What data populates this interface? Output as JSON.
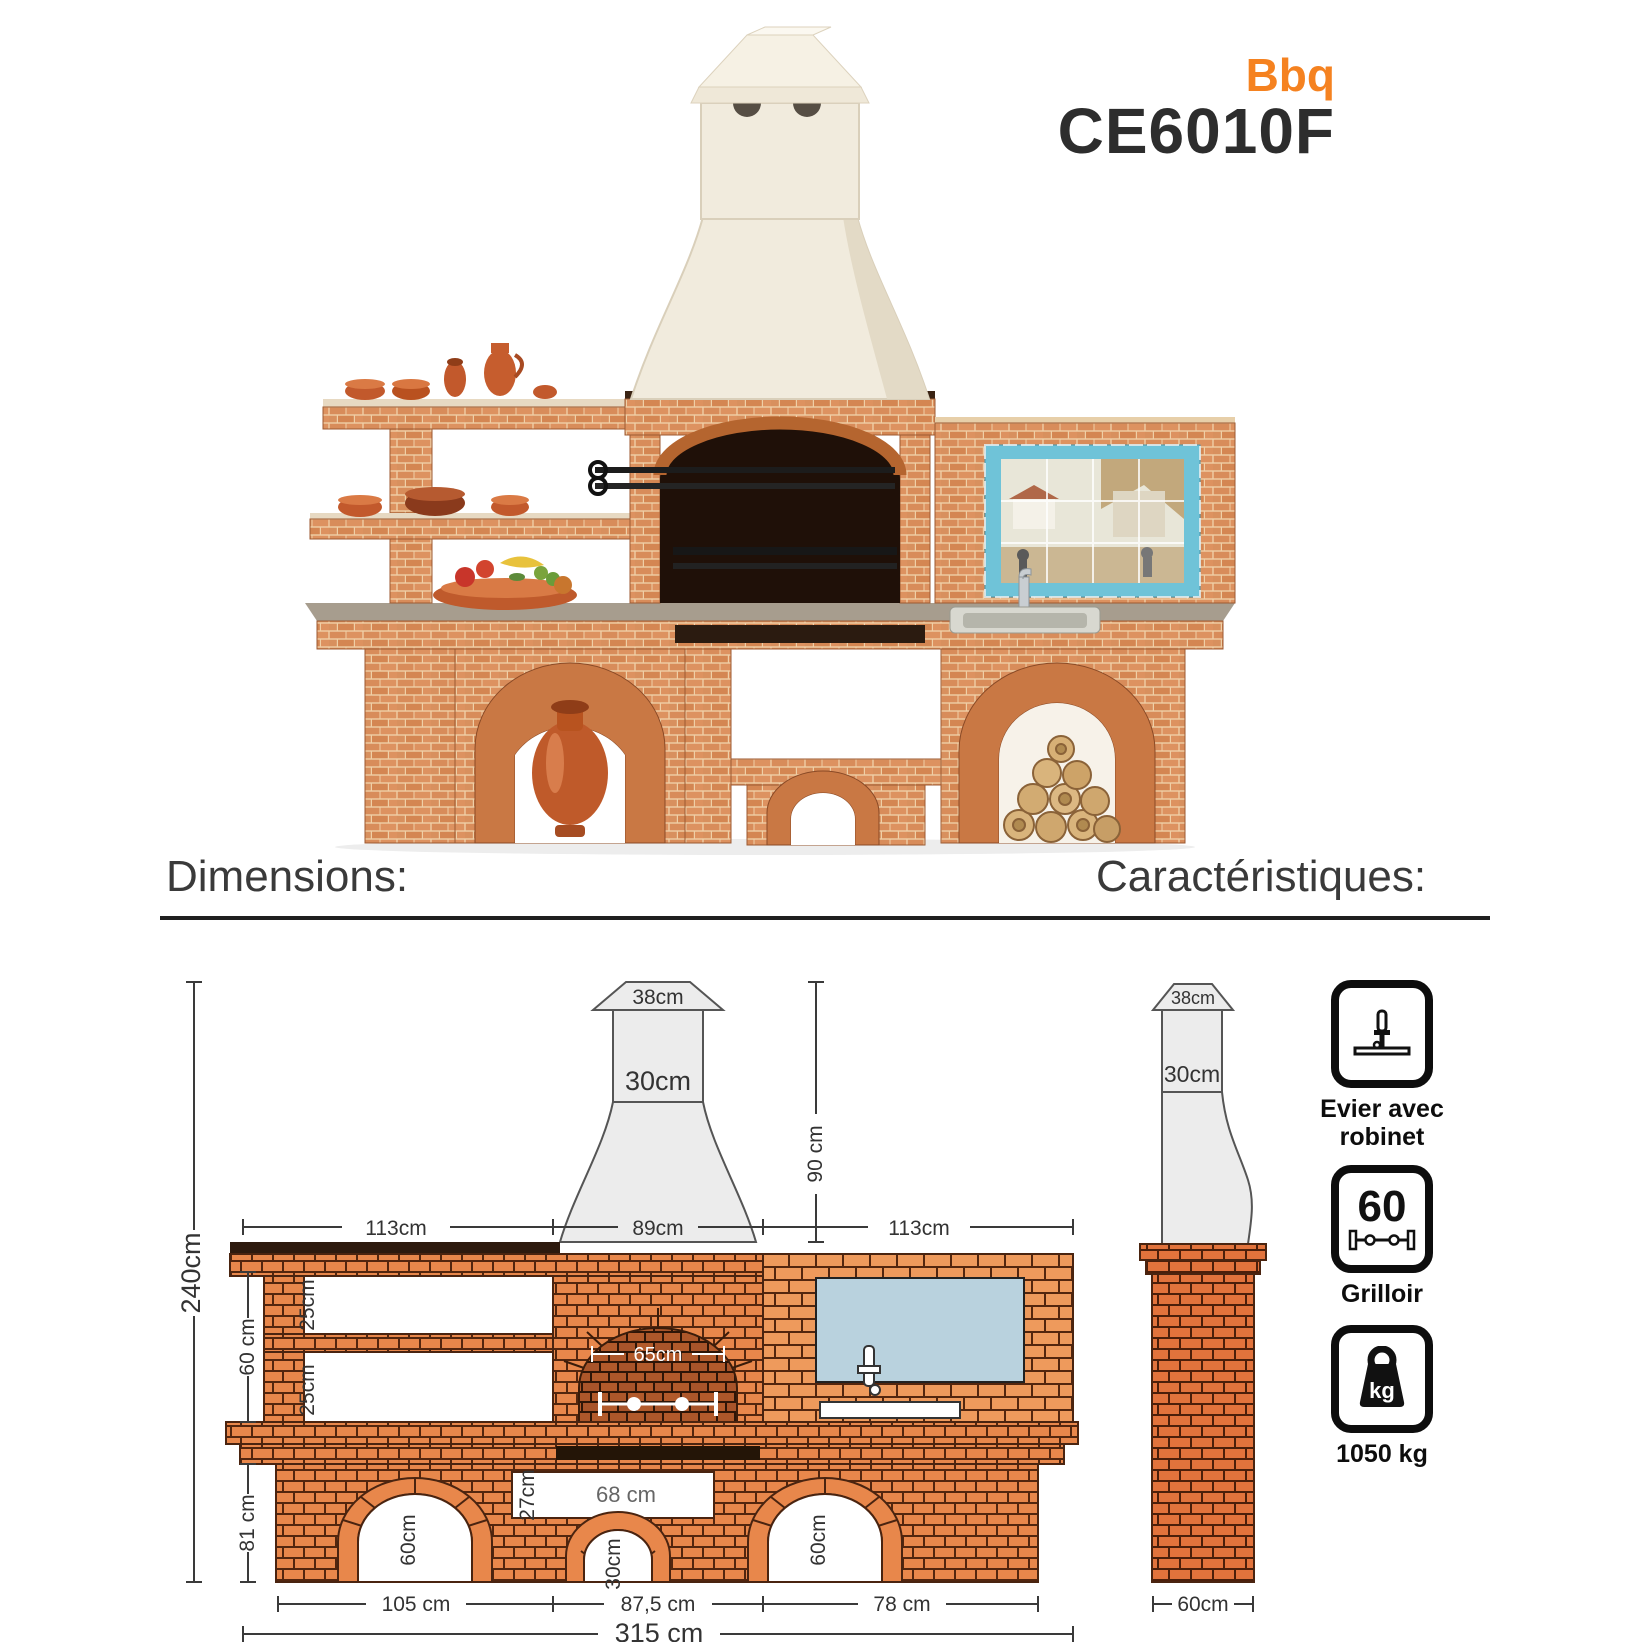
{
  "product": {
    "brand_tag": "Bbq",
    "model": "CE6010F",
    "accent_color": "#F58220"
  },
  "sections": {
    "dimensions_heading": "Dimensions:",
    "characteristics_heading": "Caractéristiques:"
  },
  "drawing": {
    "front": {
      "cap_width": "38cm",
      "chimney_width": "30cm",
      "hood_height": "90 cm",
      "left_span": "113cm",
      "firebox_span": "89cm",
      "right_span": "113cm",
      "shelf_gap_upper": "25cm",
      "shelf_gap_lower": "25cm",
      "shelf_zone": "60 cm",
      "total_height": "240cm",
      "base_height": "81 cm",
      "firebox_inner": "65cm",
      "niche_height": "27cm",
      "niche_width": "68 cm",
      "arch_left": "60cm",
      "arch_center": "30cm",
      "arch_right": "60cm",
      "span_left": "105 cm",
      "span_center": "87,5 cm",
      "span_right": "78 cm",
      "total_width": "315 cm"
    },
    "side": {
      "cap_width": "38cm",
      "chimney_width": "30cm",
      "depth": "60cm"
    }
  },
  "features": {
    "items": [
      {
        "icon": "faucet-icon",
        "label": "Evier avec robinet"
      },
      {
        "icon": "spit-icon",
        "value": "60",
        "label": "Grilloir"
      },
      {
        "icon": "weight-icon",
        "badge": "kg",
        "label": "1050 kg"
      }
    ]
  }
}
